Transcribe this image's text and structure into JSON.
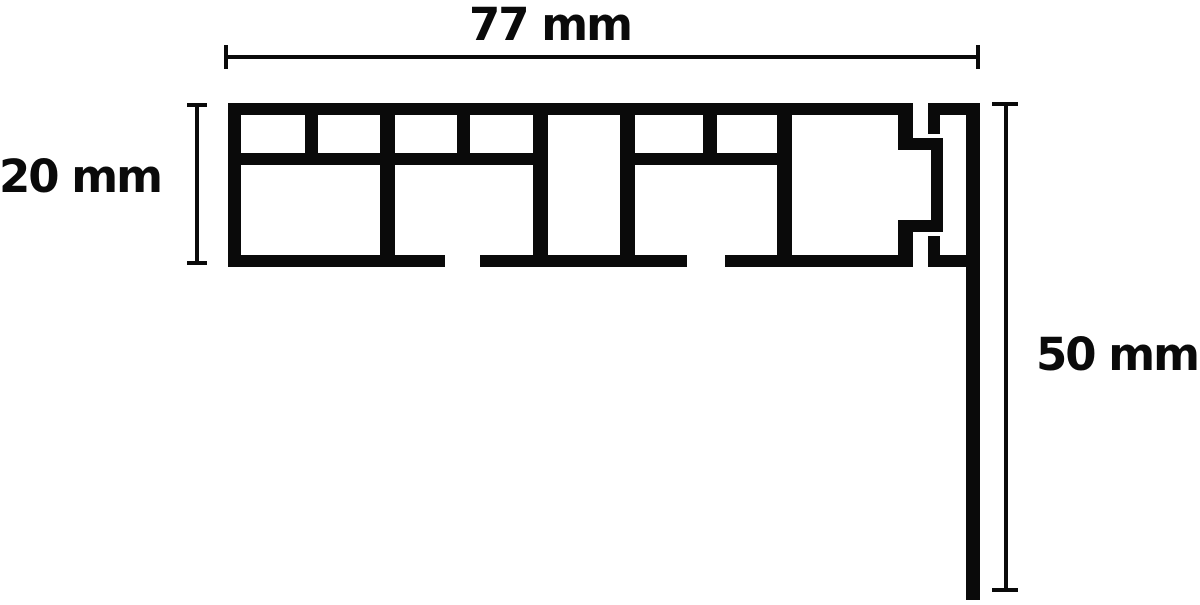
{
  "diagram": {
    "kind": "profile-cross-section-drawing",
    "background_color": "#ffffff",
    "line_color": "#0a0a0a",
    "dimensions": {
      "width": {
        "label": "77 mm",
        "value": 77,
        "unit": "mm",
        "orientation": "horizontal"
      },
      "height": {
        "label": "20 mm",
        "value": 20,
        "unit": "mm",
        "orientation": "vertical"
      },
      "drop": {
        "label": "50 mm",
        "value": 50,
        "unit": "mm",
        "orientation": "vertical"
      }
    }
  }
}
